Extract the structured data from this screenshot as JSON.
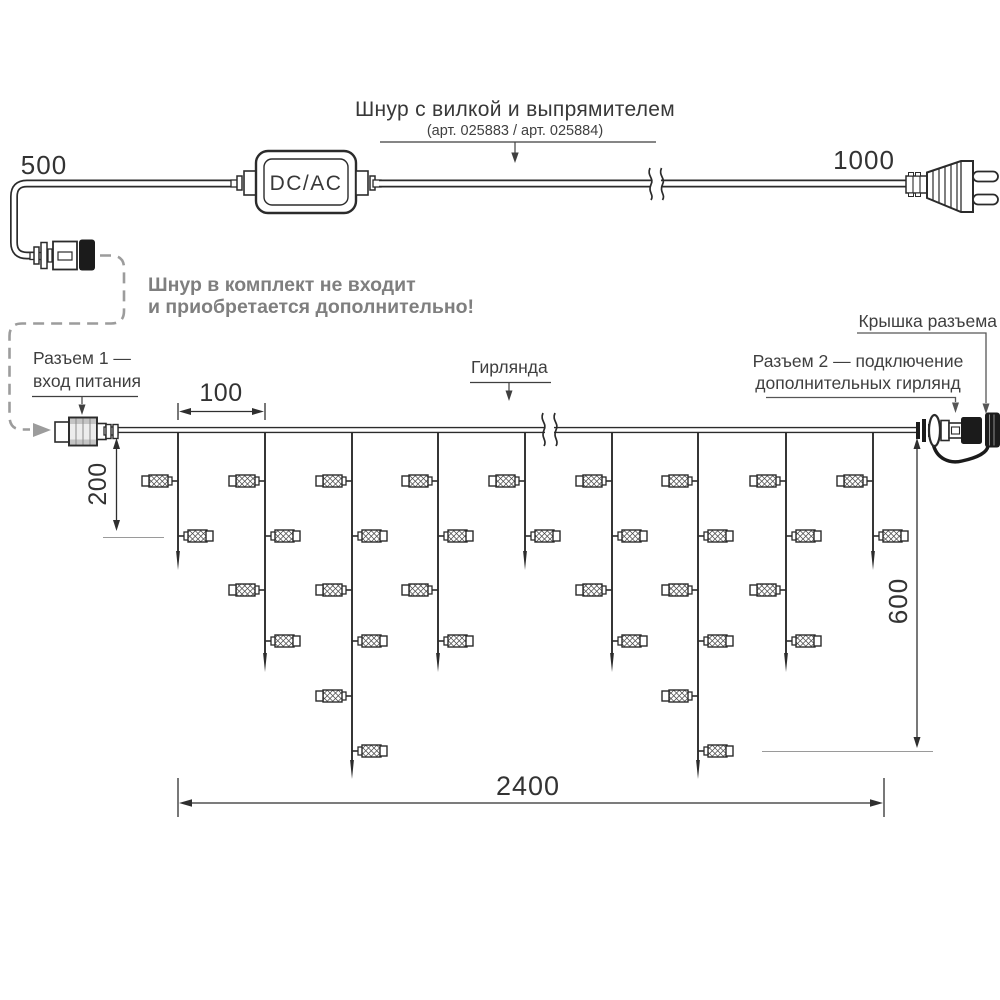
{
  "power_cord": {
    "title": "Шнур с вилкой и выпрямителем",
    "subtitle": "(арт. 025883 / арт. 025884)",
    "adapter_label": "DC/AC",
    "left_length": "500",
    "right_length": "1000",
    "note_line1": "Шнур в комплект не входит",
    "note_line2": "и приобретается дополнительно!"
  },
  "callouts": {
    "connector1_line1": "Разъем 1 —",
    "connector1_line2": "вход питания",
    "garland": "Гирлянда",
    "cap": "Крышка разъема",
    "connector2_line1": "Разъем 2 — подключение",
    "connector2_line2": "дополнительных гирлянд"
  },
  "dimensions": {
    "drop_spacing": "100",
    "first_drop_length": "200",
    "max_drop_length": "600",
    "total_width": "2400"
  },
  "colors": {
    "ink": "#2b2b2b",
    "label_text": "#3a3a3a",
    "note_gray": "#7f7f7f",
    "leader_gray": "#565656",
    "dashed_gray": "#9c9c9c"
  },
  "garland": {
    "wire_y": 430,
    "wire_x1": 118,
    "wire_x2": 918,
    "drop_xs": [
      178,
      265,
      352,
      438,
      525,
      612,
      698,
      786,
      873
    ],
    "drop_types": [
      "short",
      "medium",
      "long",
      "medium",
      "short",
      "medium",
      "long",
      "medium",
      "short"
    ],
    "tip_y": {
      "short": 570,
      "medium": 672,
      "long": 779
    },
    "bulb_count": {
      "short": 2,
      "medium": 4,
      "long": 6
    },
    "bulb_row_ys": [
      481,
      536,
      590,
      641,
      696,
      751
    ]
  }
}
